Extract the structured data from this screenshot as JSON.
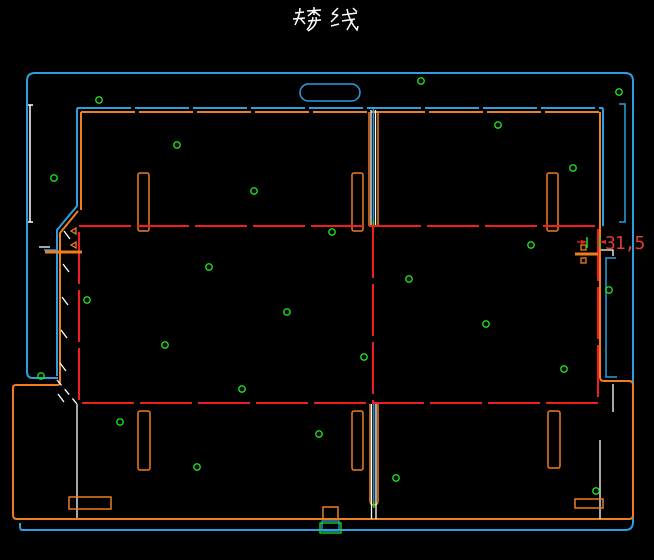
{
  "title": {
    "text": "矮线"
  },
  "dimension": {
    "label": "31,5"
  },
  "colors": {
    "frame_blue": "#2b9fe0",
    "cut_orange": "#ee7e20",
    "highlight_red": "#f21d1d",
    "marker_green": "#1fdf1f",
    "bridge_white": "#ffffff",
    "dimension_red": "#e23a2c",
    "background": "#000000"
  },
  "markers": {
    "shape": "small-circle",
    "radius": 3.2,
    "positions": [
      [
        99,
        100
      ],
      [
        421,
        81
      ],
      [
        619,
        92
      ],
      [
        177,
        145
      ],
      [
        498,
        125
      ],
      [
        254,
        191
      ],
      [
        573,
        168
      ],
      [
        54,
        178
      ],
      [
        531,
        245
      ],
      [
        332,
        232
      ],
      [
        209,
        267
      ],
      [
        87,
        300
      ],
      [
        409,
        279
      ],
      [
        486,
        324
      ],
      [
        564,
        369
      ],
      [
        609,
        290
      ],
      [
        165,
        345
      ],
      [
        364,
        357
      ],
      [
        242,
        389
      ],
      [
        287,
        312
      ],
      [
        41,
        376
      ],
      [
        120,
        422
      ],
      [
        197,
        467
      ],
      [
        319,
        434
      ],
      [
        396,
        478
      ],
      [
        596,
        491
      ]
    ]
  }
}
